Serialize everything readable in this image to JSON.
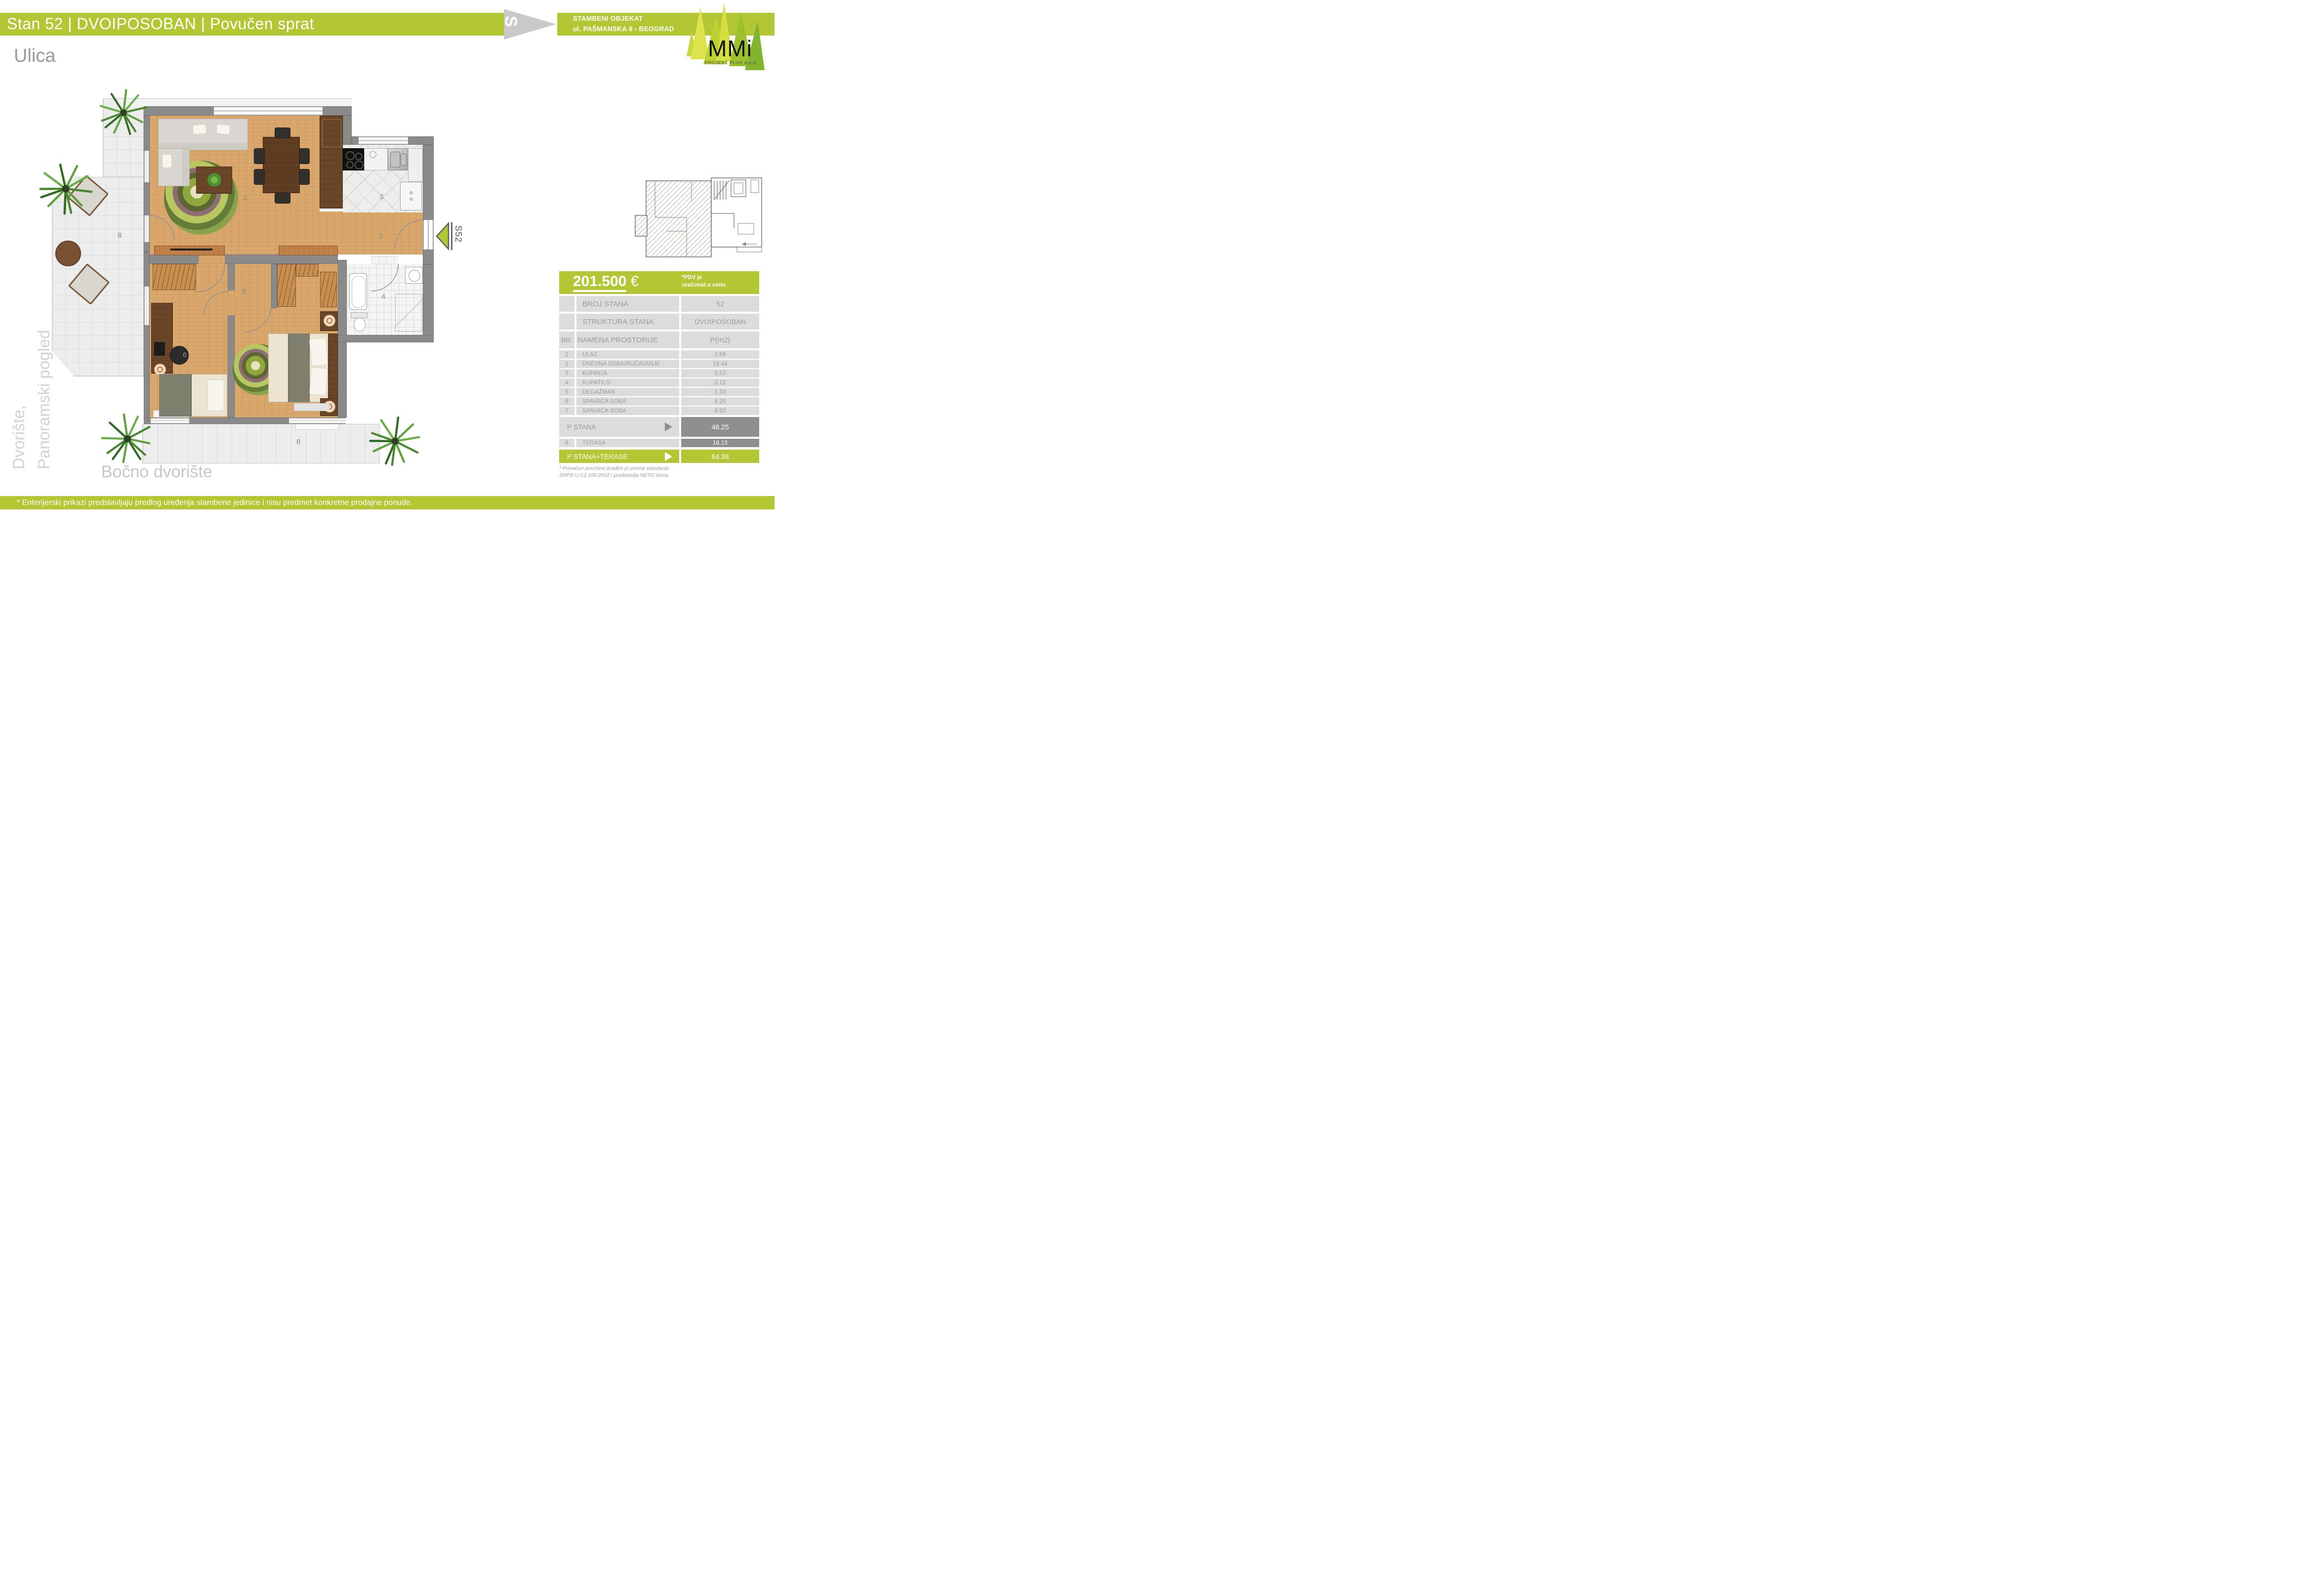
{
  "header": {
    "title": "Stan 52 | DVOIPOSOBAN | Povučen sprat",
    "building_line1": "STAMBENI OBJEKAT",
    "building_line2": "ul. PAŠMANSKA 8 - BEOGRAD",
    "s_mark": "S"
  },
  "logo": {
    "name": "MMi",
    "subtitle": "PROJEKT PLUS  d.o.o."
  },
  "surroundings": {
    "top": "Ulica",
    "left_line1": "Dvorište,",
    "left_line2": "Panoramski pogled",
    "bottom": "Bočno dvorište"
  },
  "plan": {
    "unit_marker": "S52",
    "fridge_icon": "❄❄",
    "room_labels": {
      "entry": "1",
      "living": "2",
      "kitchen": "3",
      "bath": "4",
      "hall": "5",
      "bedroom1": "6",
      "terrace_left": "8",
      "terrace_bottom": "8"
    }
  },
  "price": {
    "amount": "201.500",
    "currency": "€",
    "vat_line1": "*PDV  je",
    "vat_line2": "uračunat u cenu"
  },
  "info": {
    "broj_stana_label": "BROJ STANA",
    "broj_stana_value": "52",
    "struktura_label": "STRUKTURA STANA",
    "struktura_value": "DVOIPOSOBAN"
  },
  "table": {
    "col_nr": "BR.",
    "col_name": "NAMENA PROSTORIJE",
    "col_area": "P(m2)",
    "rooms": [
      {
        "nr": "1",
        "name": "ULAZ",
        "area": "2.66"
      },
      {
        "nr": "2",
        "name": "DNEVNA SOBA/RUČAVANJE",
        "area": "19.44"
      },
      {
        "nr": "3",
        "name": "KUHINJA",
        "area": "3.53"
      },
      {
        "nr": "4",
        "name": "KUPATILO",
        "area": "3.12"
      },
      {
        "nr": "5",
        "name": "DEGAŽMAN",
        "area": "1.33"
      },
      {
        "nr": "6",
        "name": "SPAVAĆA SOBA",
        "area": "8.25"
      },
      {
        "nr": "7",
        "name": "SPAVAĆA SOBA",
        "area": "9.92"
      }
    ],
    "p_stana_label": "P STANA",
    "p_stana_value": "48.25",
    "terasa_nr": "8",
    "terasa_label": "TERASA",
    "terasa_value": "16.13",
    "total_label": "P STANA+TERASE",
    "total_value": "64.38"
  },
  "footnote_line1": "* Proračun površina izrađen je prema standardu",
  "footnote_line2": "SRPS U.C2.100:2002 i predstavlja NETO iznos.",
  "disclaimer": "* Enterijerski prikazi predstavljaju predlog uređenja stambene jedinice i nisu predmet konkretne prodajne ponude.",
  "colors": {
    "accent": "#b2c733",
    "wall": "#8a8a8a",
    "dark_cell": "#8f8f8f",
    "text_gray": "#9b9b9b"
  }
}
